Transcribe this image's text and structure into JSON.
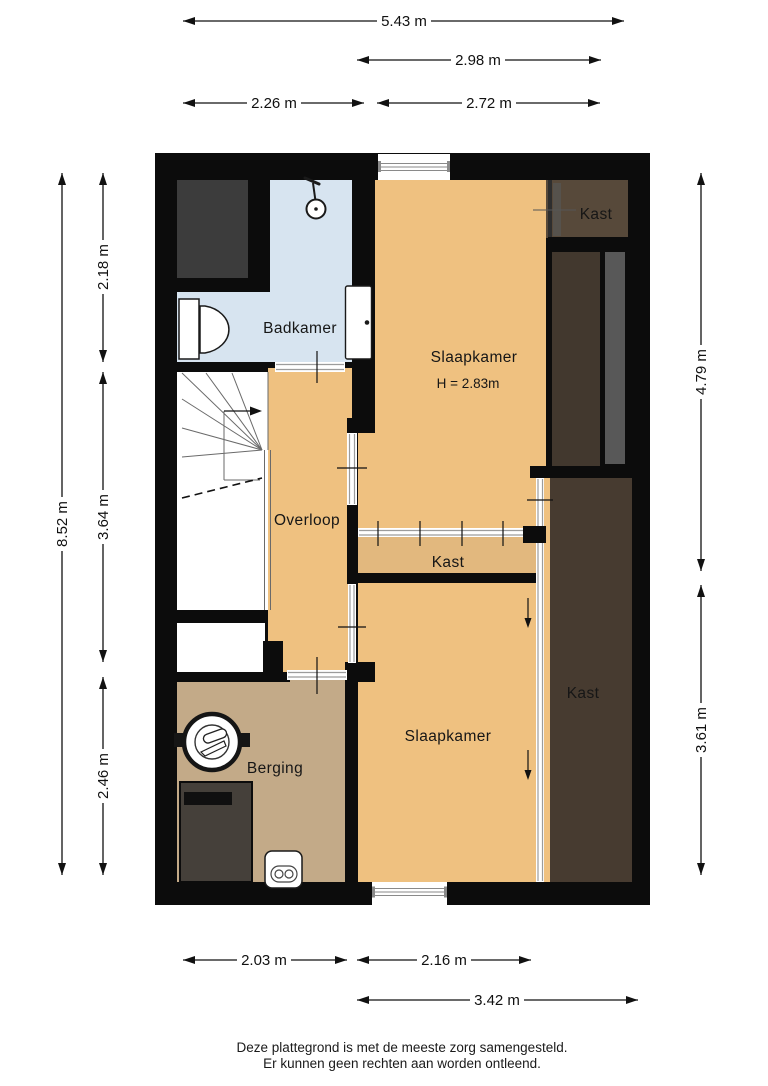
{
  "plan": {
    "type": "floor-plan",
    "floor_scale_note": "architectural plan with metric dimensions"
  },
  "colors": {
    "wall": "#0C0C0C",
    "room_orange": "#EFC180",
    "closet_interior": "#E2B87E",
    "storage_tan": "#C3AA88",
    "bathroom_blue": "#D7E4F0",
    "wardrobe_dark_brown": "#473B30",
    "wardrobe_top_brown": "#57493A",
    "void_gray": "#3C3C3C"
  },
  "rooms": {
    "badkamer": {
      "label": "Badkamer"
    },
    "slaapkamer_boven": {
      "label": "Slaapkamer",
      "ceiling_height": "H = 2.83m"
    },
    "kast_rechtsboven": {
      "label": "Kast"
    },
    "overloop": {
      "label": "Overloop"
    },
    "kast_midden": {
      "label": "Kast"
    },
    "kast_rechts": {
      "label": "Kast"
    },
    "slaapkamer_beneden": {
      "label": "Slaapkamer"
    },
    "berging": {
      "label": "Berging"
    }
  },
  "dimensions": {
    "top": [
      {
        "label": "5.43 m"
      },
      {
        "label": "2.98 m"
      },
      {
        "label": "2.26 m"
      },
      {
        "label": "2.72 m"
      }
    ],
    "bottom": [
      {
        "label": "2.03 m"
      },
      {
        "label": "2.16 m"
      },
      {
        "label": "3.42 m"
      }
    ],
    "left": [
      {
        "label": "8.52 m"
      },
      {
        "label": "2.18 m"
      },
      {
        "label": "3.64 m"
      },
      {
        "label": "2.46 m"
      }
    ],
    "right": [
      {
        "label": "4.79 m"
      },
      {
        "label": "3.61 m"
      }
    ]
  },
  "footer": {
    "line1": "Deze plattegrond is met de meeste zorg samengesteld.",
    "line2": "Er kunnen geen rechten aan worden ontleend."
  }
}
